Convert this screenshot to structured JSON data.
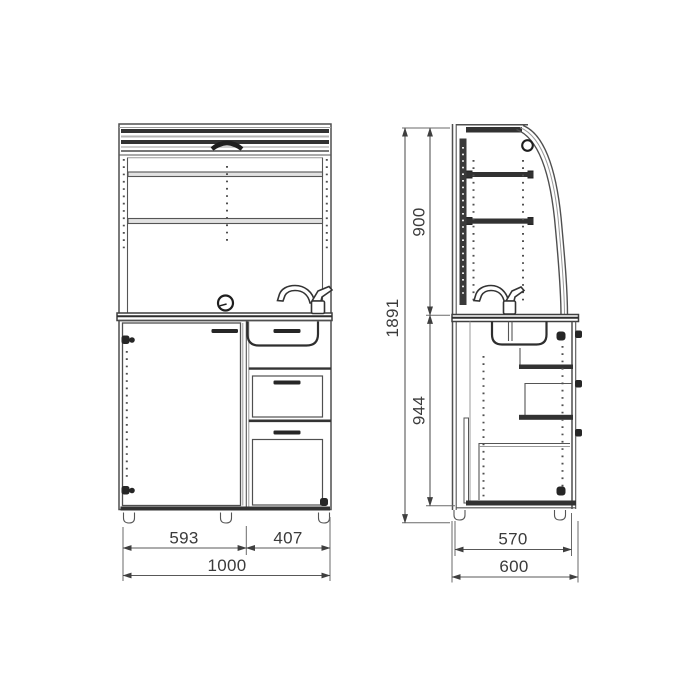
{
  "drawing": {
    "front_view": {
      "door_width": "593",
      "drawer_width": "407",
      "total_width": "1000"
    },
    "side_view": {
      "upper_section_height": "900",
      "lower_section_height": "944",
      "total_height": "1891",
      "cabinet_depth": "570",
      "total_depth": "600"
    }
  },
  "colors": {
    "background": "#ffffff",
    "line": "#4f4f4f",
    "dark_fill": "#323232",
    "dimension_text": "#3b3b3b"
  }
}
